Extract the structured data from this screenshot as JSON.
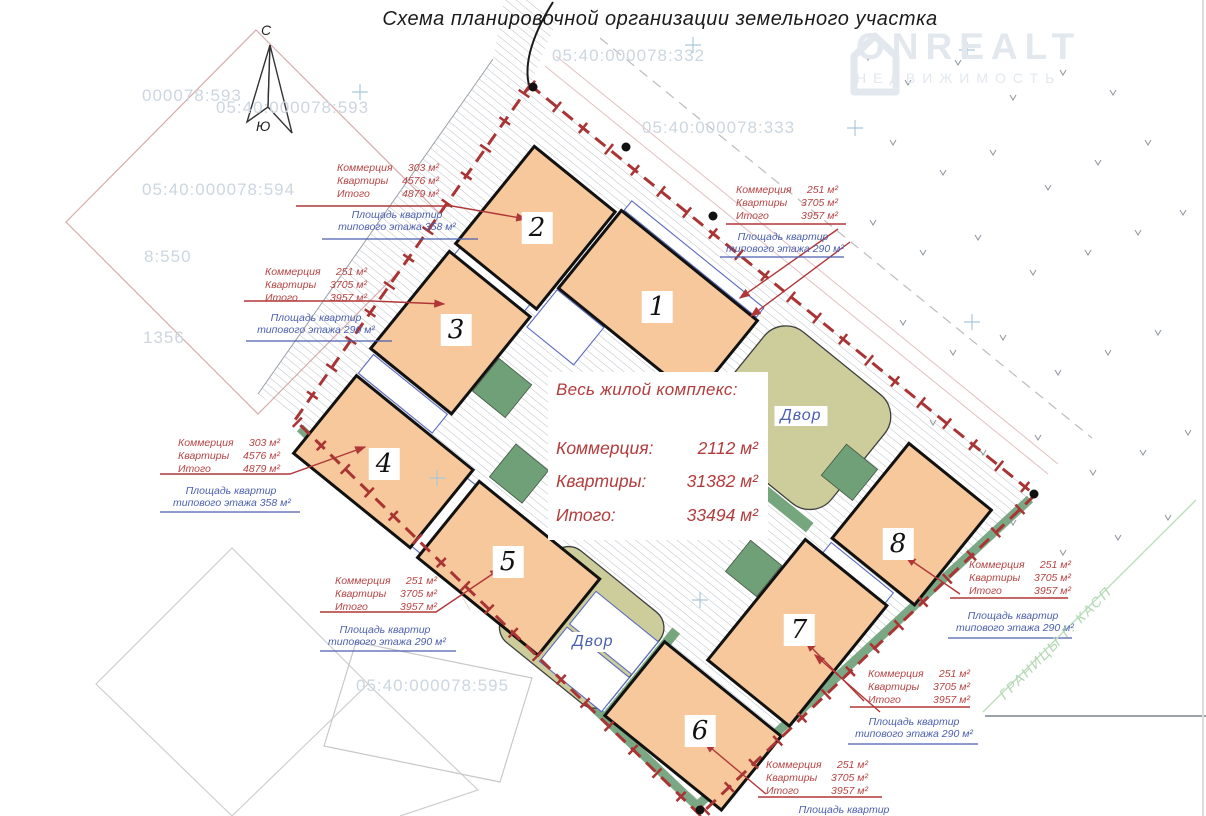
{
  "title": "Схема планировочной организации земельного участка",
  "logo": {
    "name": "ONREALT",
    "subtitle": "НЕДВИЖИМОСТЬ"
  },
  "compass": {
    "north": "С",
    "south": "Ю"
  },
  "summary": {
    "title": "Весь жилой комплекс:",
    "rows": [
      {
        "label": "Коммерция:",
        "value": "2112 м²"
      },
      {
        "label": "Квартиры:",
        "value": "31382 м²"
      },
      {
        "label": "Итого:",
        "value": "33494 м²"
      }
    ]
  },
  "buildings": [
    {
      "num": "1"
    },
    {
      "num": "2"
    },
    {
      "num": "3"
    },
    {
      "num": "4"
    },
    {
      "num": "5"
    },
    {
      "num": "6"
    },
    {
      "num": "7"
    },
    {
      "num": "8"
    }
  ],
  "courtyards": [
    {
      "label": "Двор"
    },
    {
      "label": "Двор"
    }
  ],
  "annotations": [
    {
      "rows": [
        [
          "Коммерция",
          "303 м²"
        ],
        [
          "Квартиры",
          "4576 м²"
        ],
        [
          "Итого",
          "4879 м²"
        ]
      ],
      "floor": [
        "Площадь квартир",
        "типового этажа  358 м²"
      ]
    },
    {
      "rows": [
        [
          "Коммерция",
          "251 м²"
        ],
        [
          "Квартиры",
          "3705 м²"
        ],
        [
          "Итого",
          "3957 м²"
        ]
      ],
      "floor": [
        "Площадь квартир",
        "типового этажа  290 м²"
      ]
    },
    {
      "rows": [
        [
          "Коммерция",
          "303 м²"
        ],
        [
          "Квартиры",
          "4576 м²"
        ],
        [
          "Итого",
          "4879 м²"
        ]
      ],
      "floor": [
        "Площадь квартир",
        "типового этажа  358 м²"
      ]
    },
    {
      "rows": [
        [
          "Коммерция",
          "251 м²"
        ],
        [
          "Квартиры",
          "3705 м²"
        ],
        [
          "Итого",
          "3957 м²"
        ]
      ],
      "floor": [
        "Площадь квартир",
        "типового этажа  290 м²"
      ]
    },
    {
      "rows": [
        [
          "Коммерция",
          "251 м²"
        ],
        [
          "Квартиры",
          "3705 м²"
        ],
        [
          "Итого",
          "3957 м²"
        ]
      ],
      "floor": [
        "Площадь квартир",
        "типового этажа  290 м²"
      ]
    },
    {
      "rows": [
        [
          "Коммерция",
          "251 м²"
        ],
        [
          "Квартиры",
          "3705 м²"
        ],
        [
          "Итого",
          "3957 м²"
        ]
      ],
      "floor": [
        "Площадь квартир",
        "типового этажа  290 м²"
      ]
    },
    {
      "rows": [
        [
          "Коммерция",
          "251 м²"
        ],
        [
          "Квартиры",
          "3705 м²"
        ],
        [
          "Итого",
          "3957 м²"
        ]
      ],
      "floor": [
        "Площадь квартир",
        "типового этажа  290 м²"
      ]
    },
    {
      "rows": [
        [
          "Коммерция",
          "251 м²"
        ],
        [
          "Квартиры",
          "3705 м²"
        ],
        [
          "Итого",
          "3957 м²"
        ]
      ],
      "floor": [
        "Площадь квартир"
      ]
    }
  ],
  "cadastral": [
    "000078:593",
    "05:40:000078:593",
    "05:40:000078:594",
    "8:550",
    "1356",
    "05:40:000078:332",
    "05:40:000078:333",
    "05:40:000078:595"
  ],
  "boundary_label": "ГРАНИЦЫ Г. КАСП",
  "colors": {
    "building_fill": "#f6c89b",
    "courtyard_fill": "#cdcd9b",
    "green": "#76a67e",
    "boundary_red": "#a93434",
    "annotation_red": "#b64444",
    "annotation_blue": "#4a5fae",
    "cadastral_gray": "#ccd6e0",
    "logo_gray": "#e2e8ee",
    "summary_red": "#b23c3c"
  }
}
